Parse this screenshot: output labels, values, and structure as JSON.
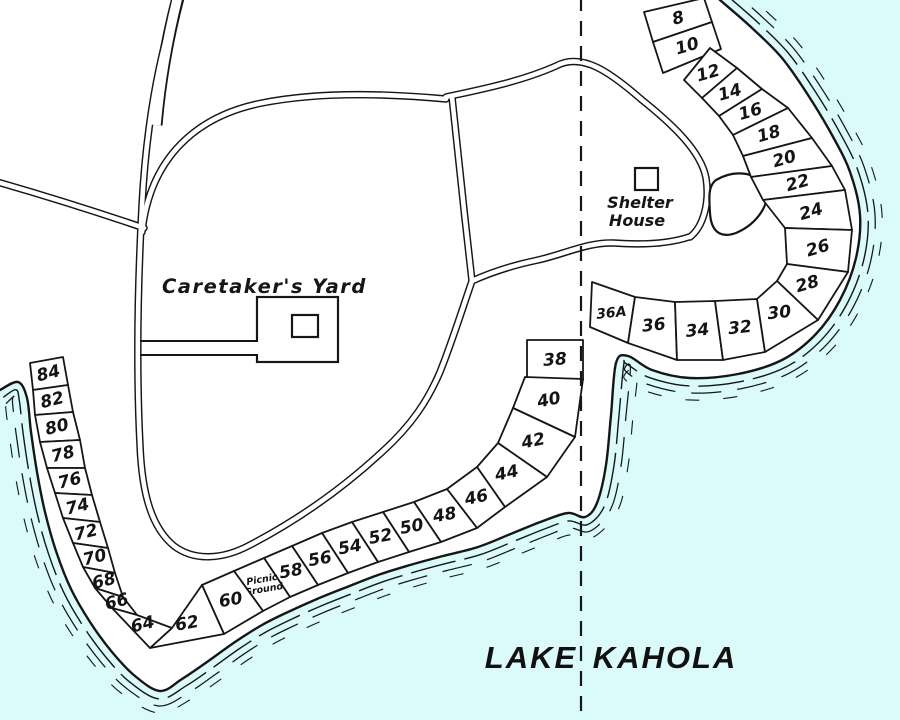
{
  "map": {
    "lake_name_left": "LAKE",
    "lake_name_right": "KAHOLA",
    "labels": {
      "caretakers_yard": "Caretaker's  Yard",
      "shelter_house_line1": "Shelter",
      "shelter_house_line2": "House",
      "picnic_ground_line1": "Picnic",
      "picnic_ground_line2": "Ground"
    },
    "lots": {
      "north_block": [
        "8",
        "10"
      ],
      "northeast_shore": [
        "12",
        "14",
        "16",
        "18",
        "20",
        "22",
        "24",
        "26",
        "28"
      ],
      "south_of_shelter": [
        "36A",
        "36",
        "34",
        "32",
        "30"
      ],
      "standalone": [
        "38"
      ],
      "southeast_shore": [
        "40",
        "42",
        "44",
        "46"
      ],
      "south_shore": [
        "48",
        "50",
        "52",
        "54",
        "56",
        "58"
      ],
      "south_shore_west_of_picnic": [
        "60",
        "62"
      ],
      "west_shore": [
        "84",
        "82",
        "80",
        "78",
        "76",
        "74",
        "72",
        "70",
        "68",
        "66",
        "64"
      ]
    },
    "colors": {
      "water": "#dbfafa",
      "land": "#ffffff",
      "line": "#161616"
    }
  }
}
